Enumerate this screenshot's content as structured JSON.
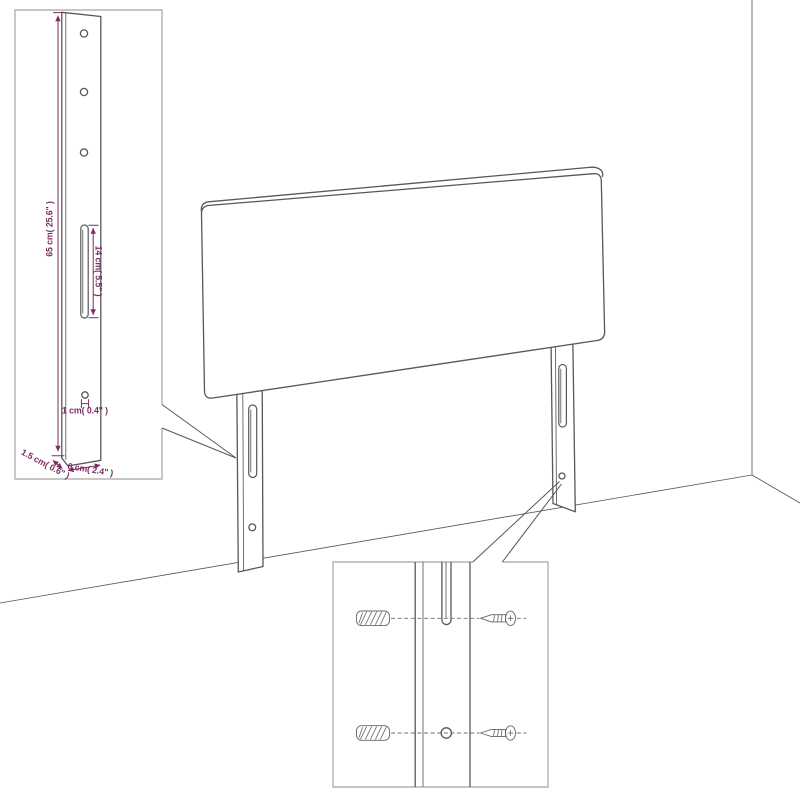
{
  "colors": {
    "background": "#ffffff",
    "line": "#575757",
    "inset_border": "#a3a3a3",
    "dimension": "#7a2e63"
  },
  "insets": {
    "post_detail": {
      "dimensions": {
        "height": "65 cm( 25.6\" )",
        "slot_length": "14 cm( 5.5\" )",
        "hole_diameter": "1 cm( 0.4\" )",
        "depth": "1.5 cm( 0.6\" )",
        "width": "6 cm( 2.4\" )"
      }
    },
    "fastener_detail": {
      "rows": 2,
      "items_per_row": [
        "wall-plug-icon",
        "screw-icon"
      ]
    }
  },
  "icons": {
    "wall_plug": "wall-plug-icon",
    "screw": "screw-icon",
    "mounting_hole": "hole-icon",
    "slot": "slot-icon"
  }
}
